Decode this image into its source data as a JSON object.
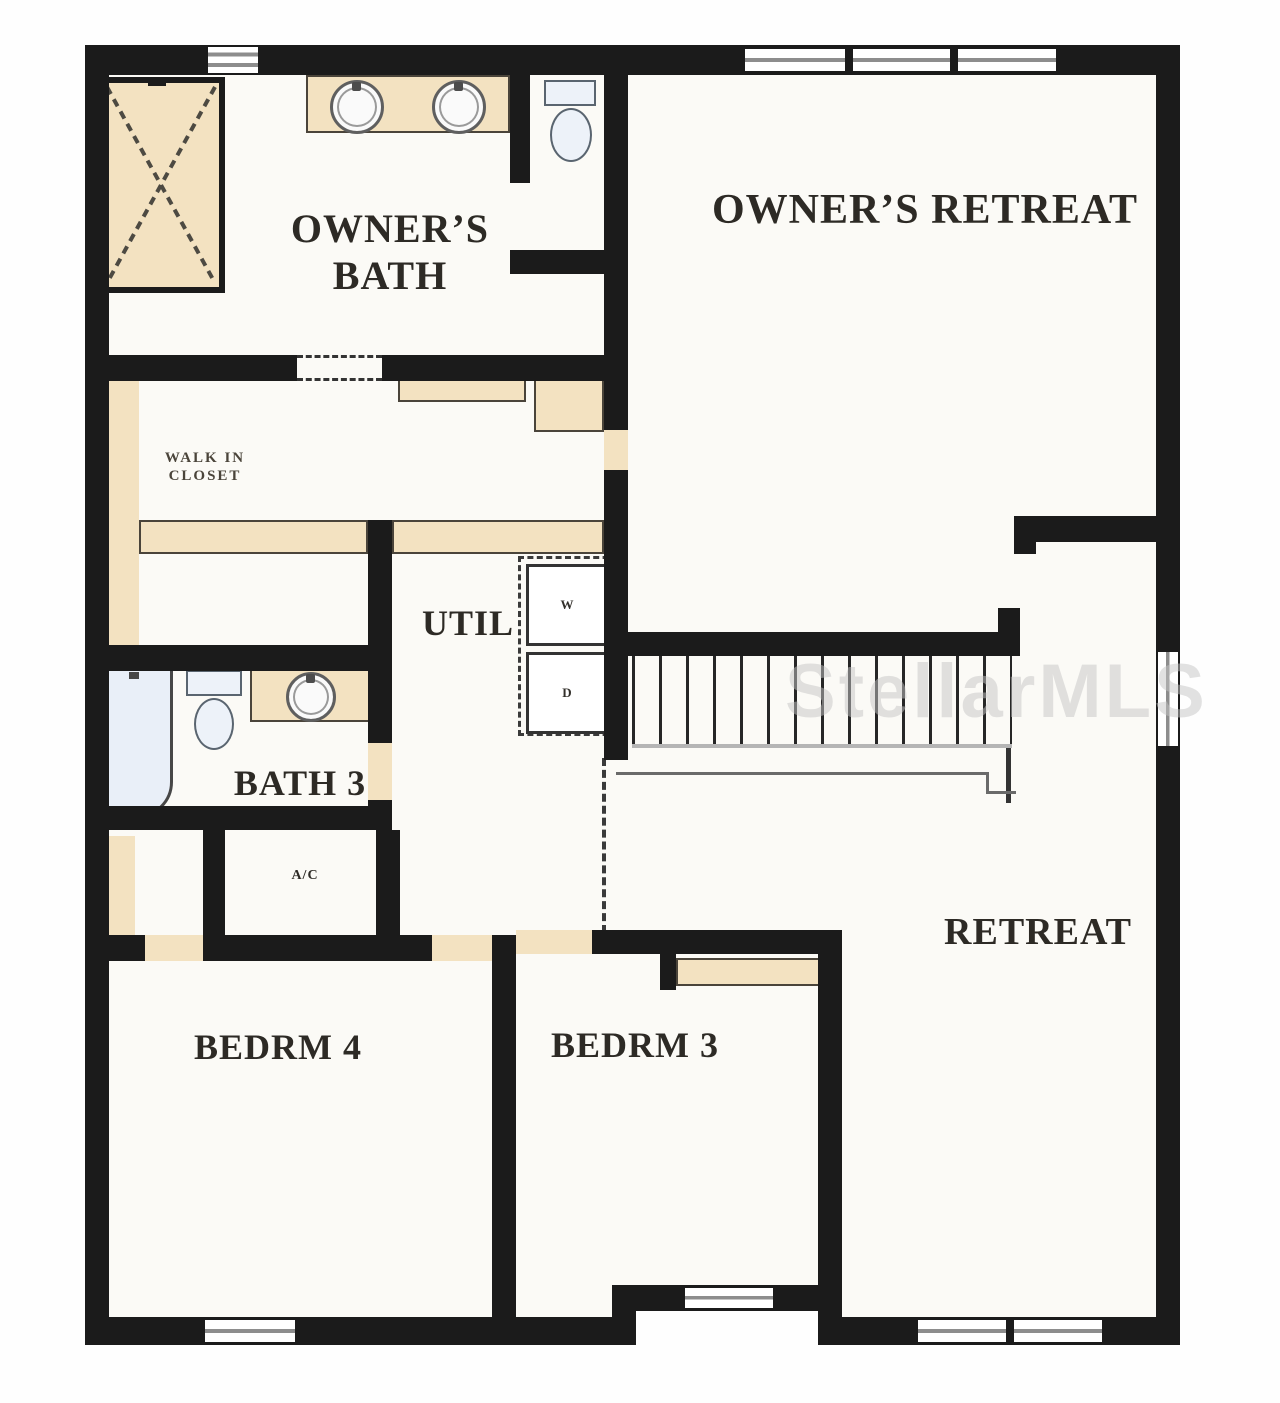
{
  "plan_title": "second-floor-plan",
  "watermark": "StellarMLS",
  "colors": {
    "wall": "#1b1b1b",
    "floor": "#fbfaf6",
    "cabinet_tan": "#f3e2c1",
    "fixture_blue": "#e9eff8",
    "window_line": "#8d8d8d",
    "label_text": "#2d2a25",
    "watermark_gray": "#c6c6c6"
  },
  "rooms": {
    "owners_bath": {
      "line1": "OWNER’S",
      "line2": "BATH"
    },
    "owners_retreat": {
      "label": "OWNER’S RETREAT"
    },
    "walk_in_closet": {
      "line1": "WALK IN",
      "line2": "CLOSET"
    },
    "util": {
      "label": "UTIL"
    },
    "bath3": {
      "label": "BATH 3"
    },
    "ac_closet": {
      "label": "A/C"
    },
    "bedroom4": {
      "label": "BEDRM 4"
    },
    "bedroom3": {
      "label": "BEDRM 3"
    },
    "retreat": {
      "label": "RETREAT"
    }
  },
  "appliances": {
    "washer": "W",
    "dryer": "D"
  },
  "fixtures": [
    "shower-stall",
    "double-vanity-sinks",
    "toilet-owners-bath",
    "bathtub",
    "toilet-bath3",
    "vanity-sink-bath3",
    "washer",
    "dryer",
    "staircase-with-railing"
  ]
}
